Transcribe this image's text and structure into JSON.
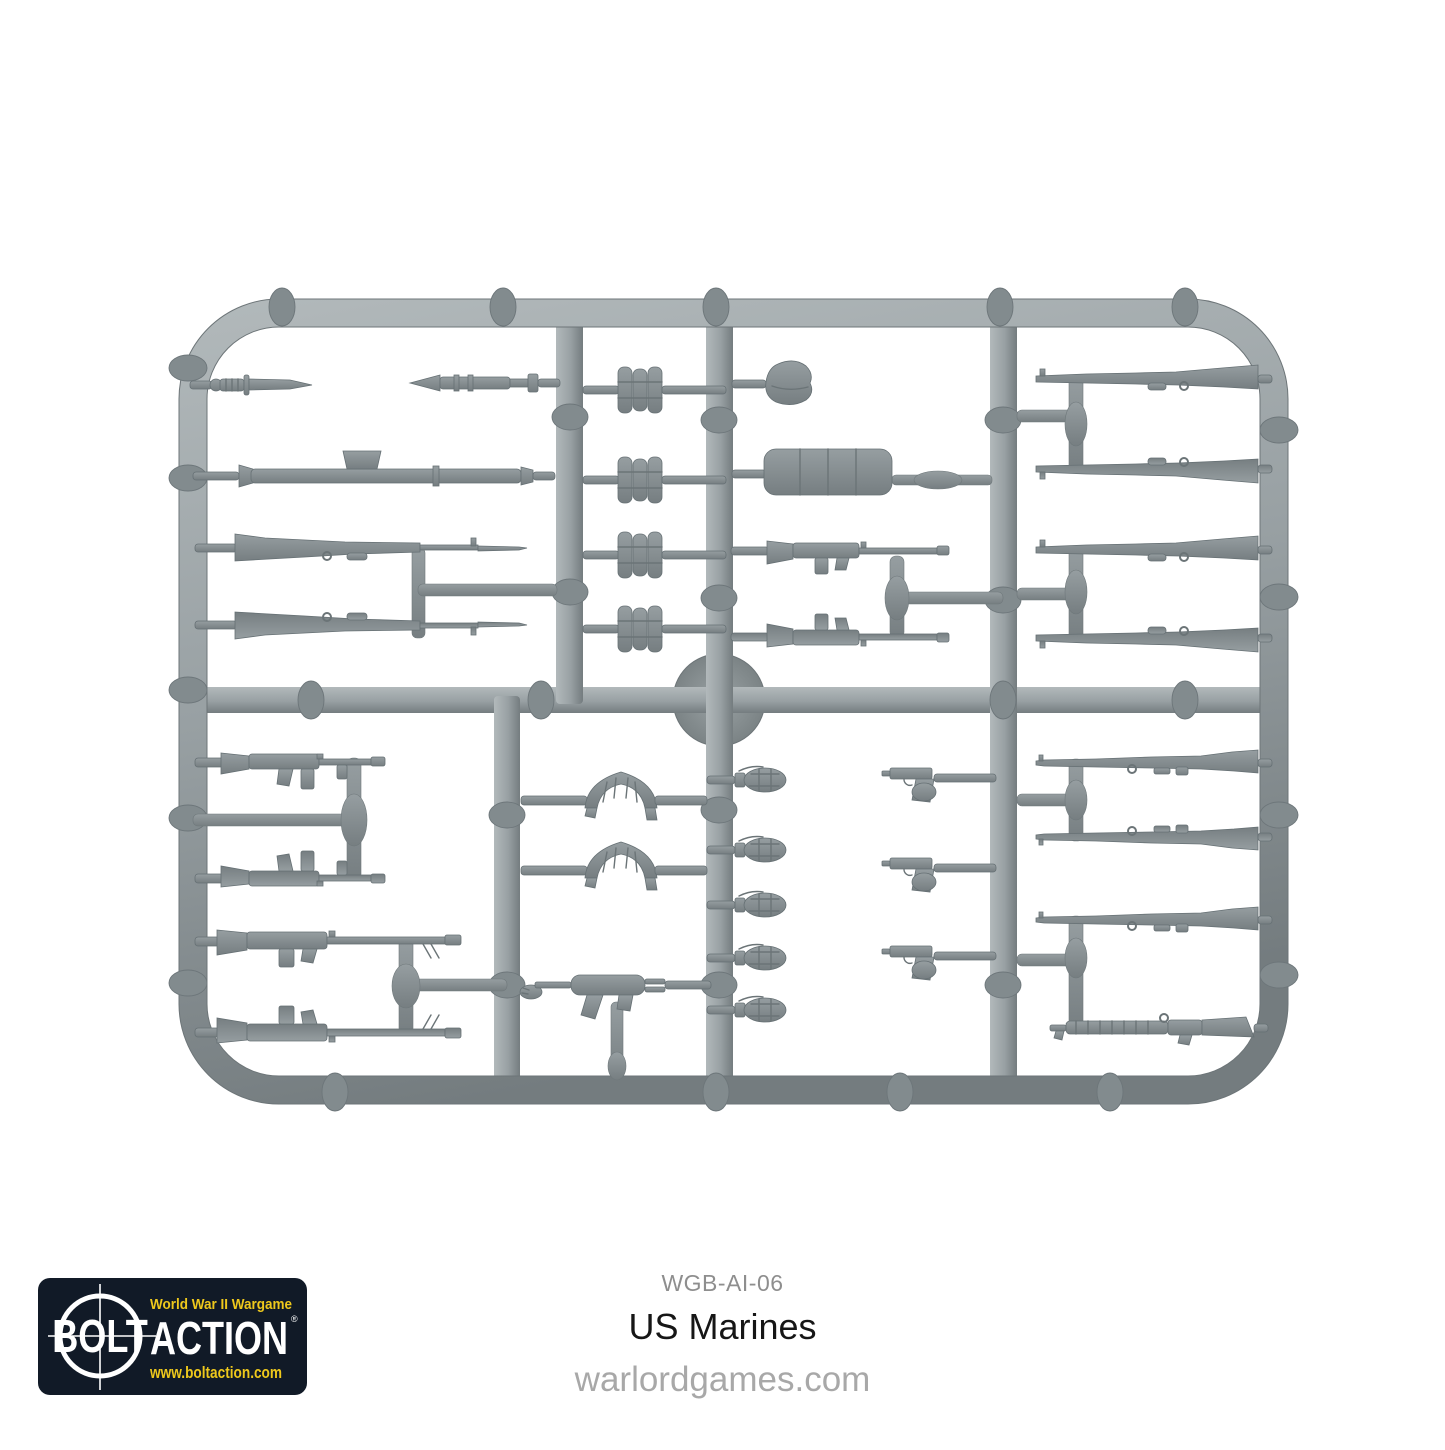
{
  "page": {
    "type": "product-photo-on-white"
  },
  "product": {
    "code": "WGB-AI-06",
    "name": "US Marines",
    "website": "warlordgames.com"
  },
  "logo": {
    "tagline": "World War II Wargame",
    "brand_left": "BOLT",
    "brand_right": "ACTION",
    "registered": "®",
    "url": "www.boltaction.com"
  },
  "sprue": {
    "description": "Light gray hard-plastic weapons accessory sprue, rounded rectangular frame with internal runners",
    "parts": [
      {
        "name": "fighting-knife",
        "qty": 1
      },
      {
        "name": "bazooka-rocket",
        "qty": 1
      },
      {
        "name": "bazooka-launcher",
        "qty": 1
      },
      {
        "name": "m1-garand-with-bayonet",
        "qty": 2
      },
      {
        "name": "grenade-bundle",
        "qty": 4
      },
      {
        "name": "utility-cap",
        "qty": 1
      },
      {
        "name": "pack-bedroll",
        "qty": 1
      },
      {
        "name": "bar-automatic-rifle",
        "qty": 4
      },
      {
        "name": "m1-garand-rifle",
        "qty": 4
      },
      {
        "name": "draped-ammo-belt",
        "qty": 2
      },
      {
        "name": "thompson-smg",
        "qty": 2
      },
      {
        "name": "m3-grease-gun",
        "qty": 1
      },
      {
        "name": "pineapple-grenade",
        "qty": 5
      },
      {
        "name": "m1911-pistol-in-hand",
        "qty": 3
      },
      {
        "name": "springfield-rifle",
        "qty": 3
      },
      {
        "name": "trench-shotgun",
        "qty": 1
      }
    ]
  },
  "colors": {
    "background": "#ffffff",
    "sprue_base": "#98a0a3",
    "sprue_light": "#b2b9bb",
    "sprue_dark": "#747c7f",
    "part_fill": "#8a9295",
    "logo_bg": "#111a27",
    "logo_yellow": "#eec81c",
    "logo_white": "#ffffff",
    "code_gray": "#8e8e8e",
    "title_black": "#161616",
    "site_gray": "#a8a8a8"
  }
}
